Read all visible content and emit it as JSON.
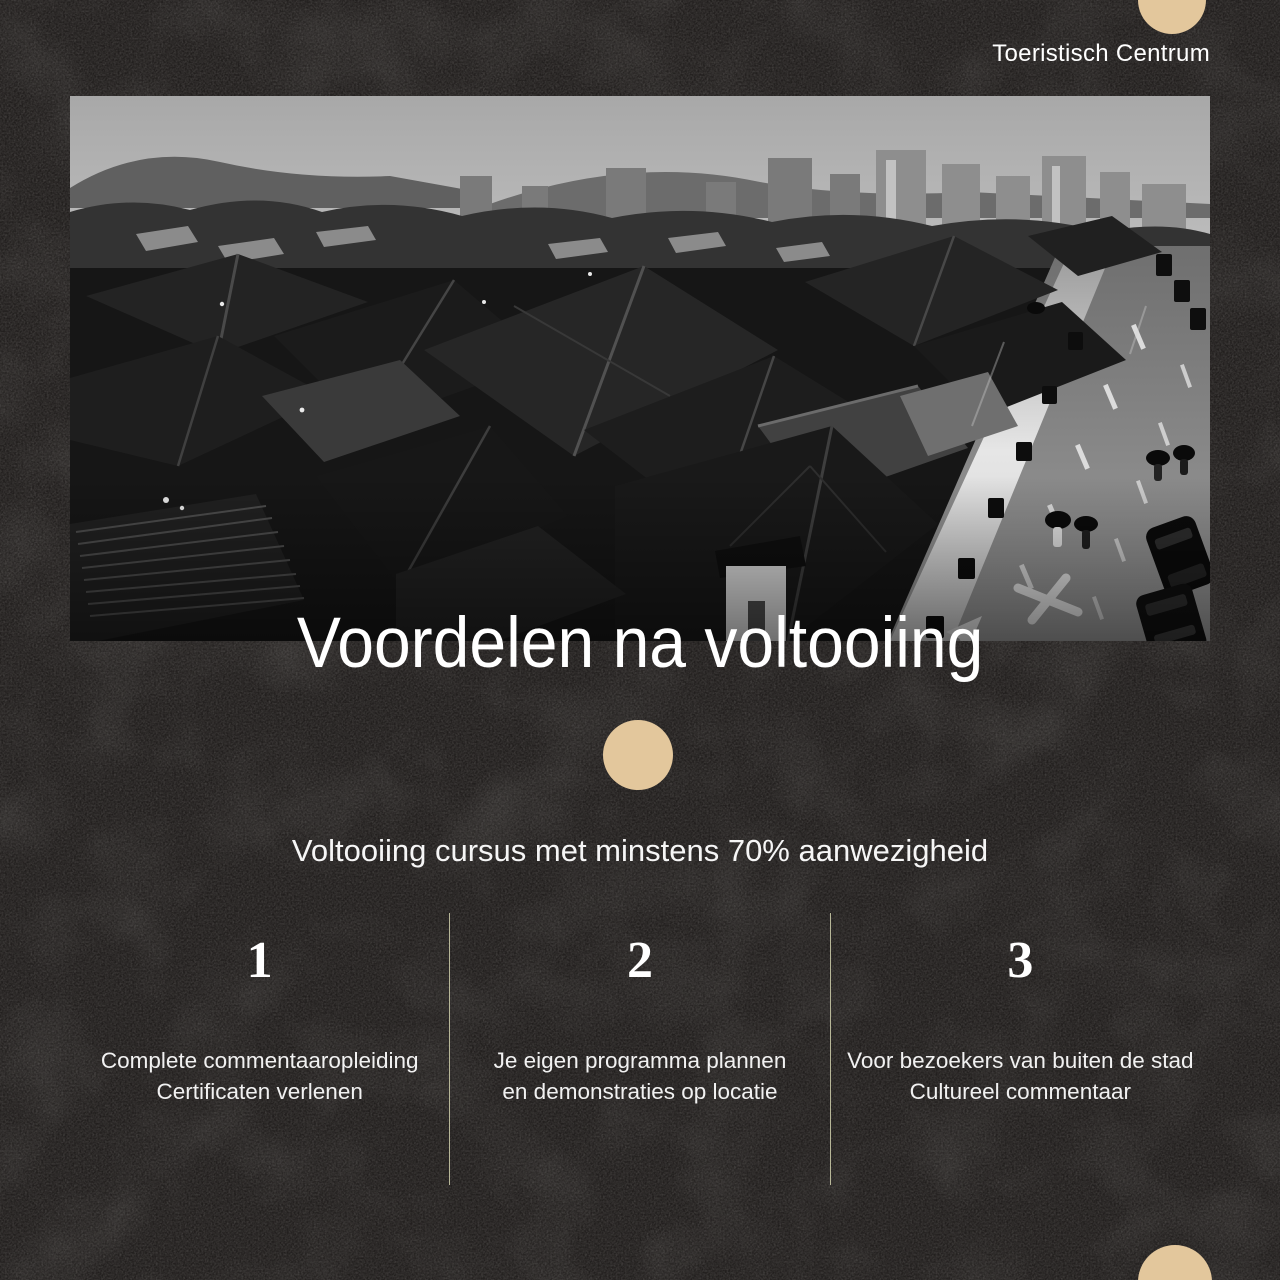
{
  "header": {
    "brand": "Toeristisch Centrum"
  },
  "hero": {
    "title": "Voordelen na voltooiing"
  },
  "subtitle": "Voltooiing cursus met minstens 70% aanwezigheid",
  "benefits": [
    {
      "number": "1",
      "lines": [
        "Complete commentaaropleiding",
        "Certificaten verlenen"
      ]
    },
    {
      "number": "2",
      "lines": [
        "Je eigen programma plannen",
        "en demonstraties op locatie"
      ]
    },
    {
      "number": "3",
      "lines": [
        "Voor bezoekers van buiten de stad",
        "Cultureel commentaar"
      ]
    }
  ],
  "colors": {
    "background": "#221f1e",
    "accent_circle": "#e3c79c",
    "divider": "#c6c6a4",
    "text": "#ffffff"
  }
}
